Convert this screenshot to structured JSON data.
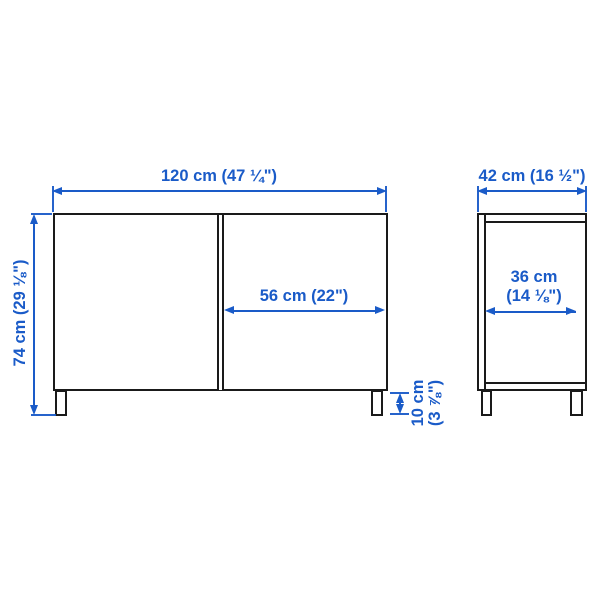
{
  "diagram_type": "furniture-dimension-drawing",
  "colors": {
    "dimension_blue": "#1a5bc8",
    "outline_black": "#1a1a1a",
    "background": "#ffffff"
  },
  "front_view": {
    "width_label": "120 cm (47 ¼\")",
    "height_label": "74 cm (29 ⅛\")",
    "door_width_label": "56 cm (22\")",
    "leg_height_label_line1": "10 cm",
    "leg_height_label_line2": "(3 ⅞\")"
  },
  "side_view": {
    "depth_label": "42 cm (16 ½\")",
    "inner_depth_label_line1": "36 cm",
    "inner_depth_label_line2": "(14 ⅛\")"
  }
}
